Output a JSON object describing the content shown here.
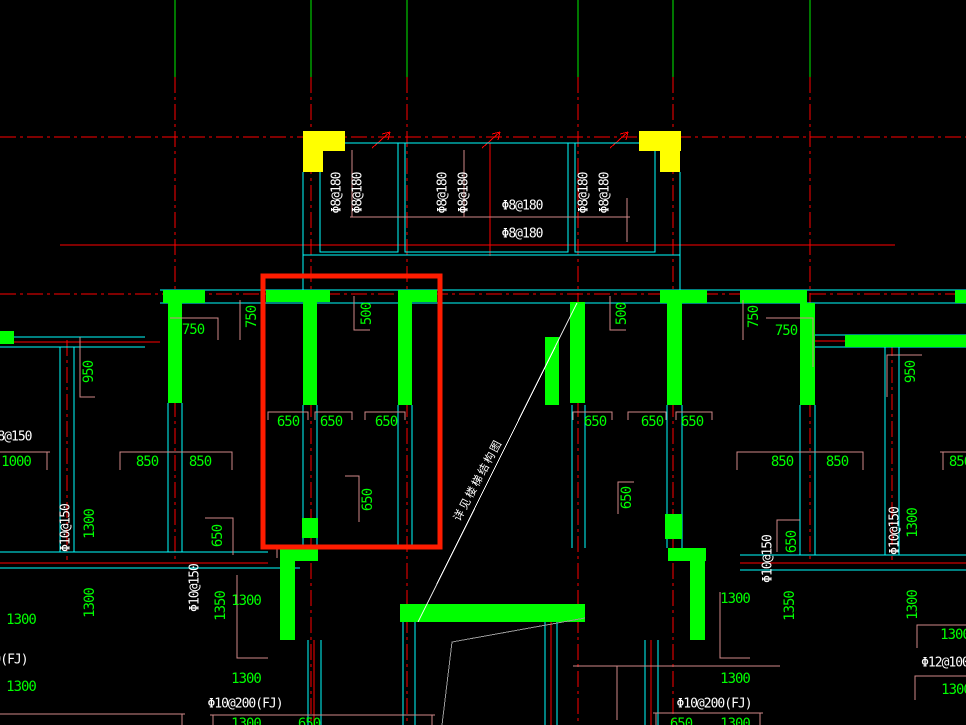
{
  "viewport": {
    "description": "Structural shear-wall plan drawing with slab reinforcement callouts and red highlight box",
    "background": "#000000"
  },
  "palette": {
    "grid_red": "#ff0000",
    "wall_green": "#00ff00",
    "outline_cyan": "#00ffff",
    "corner_yellow": "#ffff00",
    "dim_pink": "#cf8989",
    "text_white": "#ffffff",
    "highlight_red": "#ff1c00",
    "stair_gray": "#9a9a9a"
  },
  "rebar": {
    "slab_top_v": [
      "Φ8@180",
      "Φ8@180",
      "Φ8@180",
      "Φ8@180",
      "Φ8@180",
      "Φ8@180"
    ],
    "slab_top_h": [
      "Φ8@180",
      "Φ8@180"
    ],
    "left_edge": "Φ8@150",
    "wall_v": [
      "Φ10@150",
      "Φ10@150",
      "Φ10@150",
      "Φ10@150"
    ],
    "bottom": [
      "Φ10@200(FJ)",
      "Φ10@200(FJ)",
      "Φ10@200(FJ)"
    ],
    "right_edge": "Φ12@100"
  },
  "dims": {
    "v500": [
      "500",
      "500"
    ],
    "v750": [
      "750",
      "750"
    ],
    "h750": [
      "750",
      "750"
    ],
    "v950": [
      "950",
      "950"
    ],
    "row650_left": [
      "650",
      "650",
      "650"
    ],
    "row650_right": [
      "650",
      "650",
      "650"
    ],
    "v650_mid": [
      "650",
      "650"
    ],
    "v650_low": [
      "650",
      "650"
    ],
    "d650_notch": "650",
    "d650_bottom": [
      "650",
      "650"
    ],
    "d1000": "1000",
    "d850_left": [
      "850",
      "850"
    ],
    "d850_right": [
      "850",
      "850",
      "850"
    ],
    "v1300": [
      "1300",
      "1300",
      "1300",
      "1300"
    ],
    "v1350": [
      "1350",
      "1350"
    ],
    "h1300_left": [
      "1300",
      "1300",
      "1300",
      "1300",
      "1300"
    ],
    "h1300_right": [
      "1300",
      "1300",
      "1300",
      "1300",
      "1300"
    ]
  },
  "note": {
    "stair_leader": "详见楼梯结构图"
  }
}
